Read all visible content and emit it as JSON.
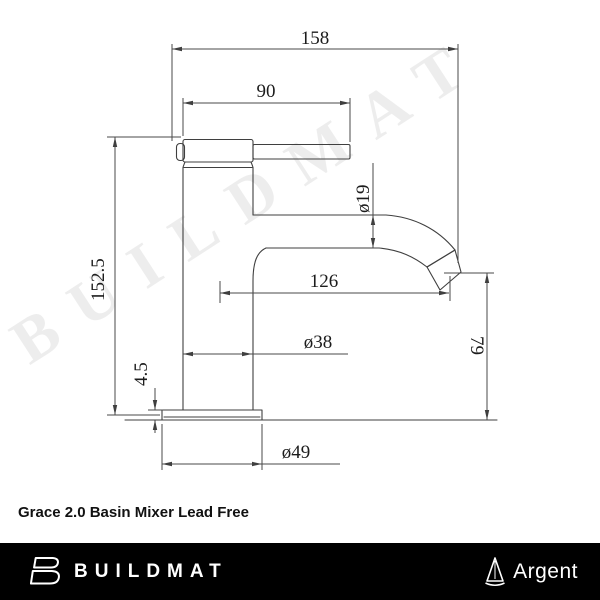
{
  "page": {
    "title": "Grace 2.0 Basin Mixer Lead Free"
  },
  "watermark": "BUILDMAT",
  "diagram": {
    "type": "technical-dimension-drawing",
    "subject": "basin mixer tap, side elevation",
    "units": "mm",
    "dimensions": {
      "overall_length": "158",
      "handle_reach": "90",
      "spout_tube_diameter": "ø19",
      "overall_height": "152.5",
      "spout_reach": "126",
      "body_diameter": "ø38",
      "base_plate_thickness": "4.5",
      "spout_outlet_height": "79",
      "base_plate_diameter": "ø49"
    }
  },
  "footer": {
    "brand": "BUILDMAT",
    "sub_brand": "Argent"
  }
}
